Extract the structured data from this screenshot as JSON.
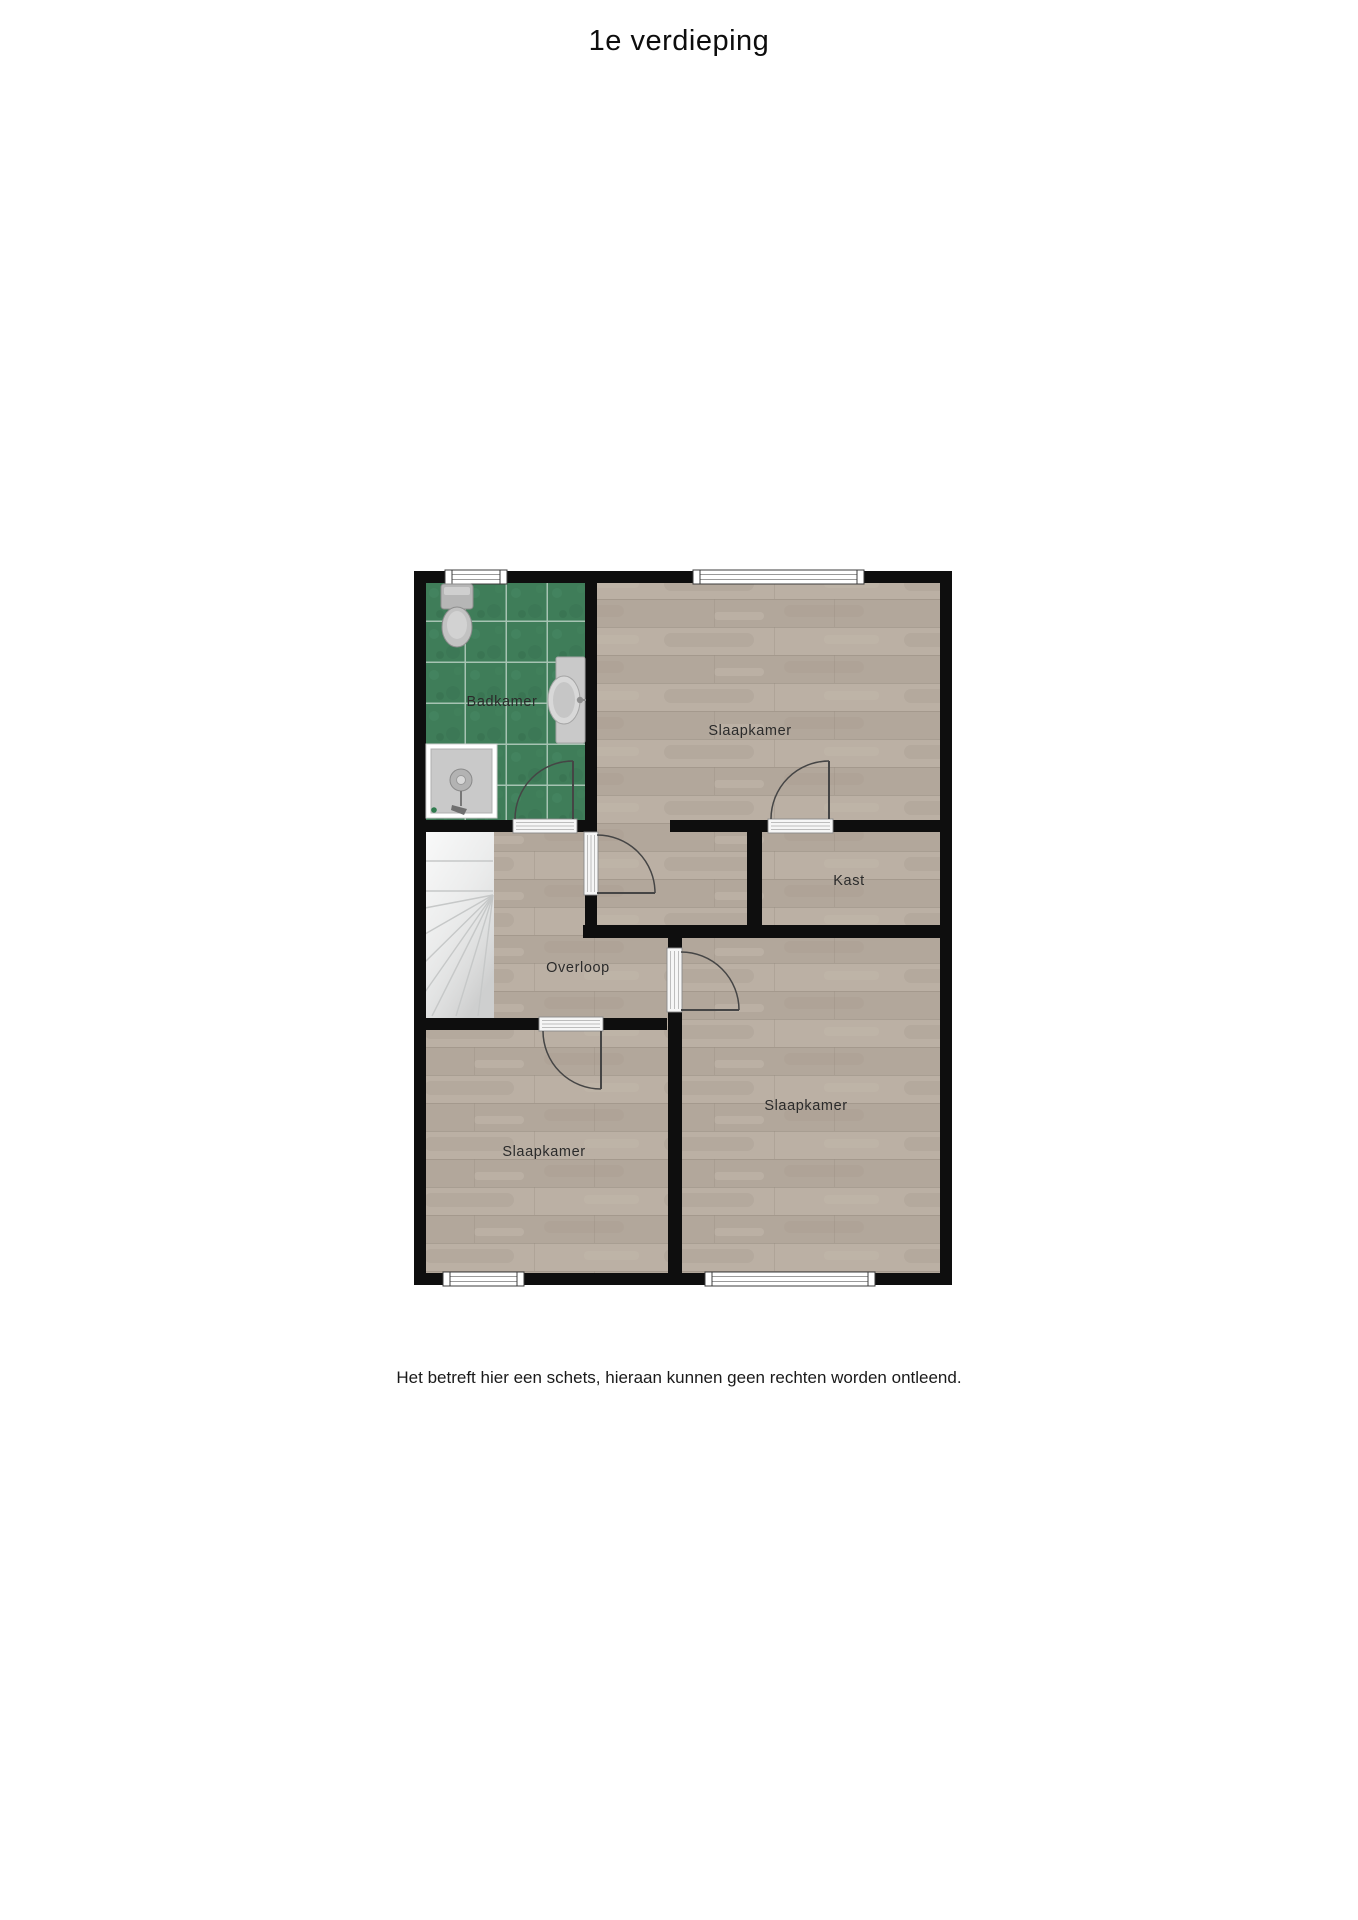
{
  "page": {
    "title": "1e verdieping",
    "disclaimer": "Het betreft hier een schets, hieraan kunnen geen rechten worden ontleend."
  },
  "floorplan": {
    "rooms": {
      "badkamer": {
        "label": "Badkamer"
      },
      "slaapkamer_noord": {
        "label": "Slaapkamer"
      },
      "kast": {
        "label": "Kast"
      },
      "overloop": {
        "label": "Overloop"
      },
      "slaapkamer_links": {
        "label": "Slaapkamer"
      },
      "slaapkamer_rechts": {
        "label": "Slaapkamer"
      }
    },
    "fixtures": [
      "toilet-icon",
      "sink-icon",
      "shower-icon",
      "stairs-icon"
    ],
    "window_count": 4,
    "door_count": 5,
    "colors": {
      "wall": "#0e0e0e",
      "tile_floor": "#3f7d59",
      "tile_grout": "#b9cfc2",
      "wood_floor": "#b6aba0",
      "stairs": "#ebecec",
      "door_line": "#454545",
      "label_text": "#2b2b2b",
      "title_text": "#0d0d0d",
      "page_bg": "#ffffff"
    }
  }
}
